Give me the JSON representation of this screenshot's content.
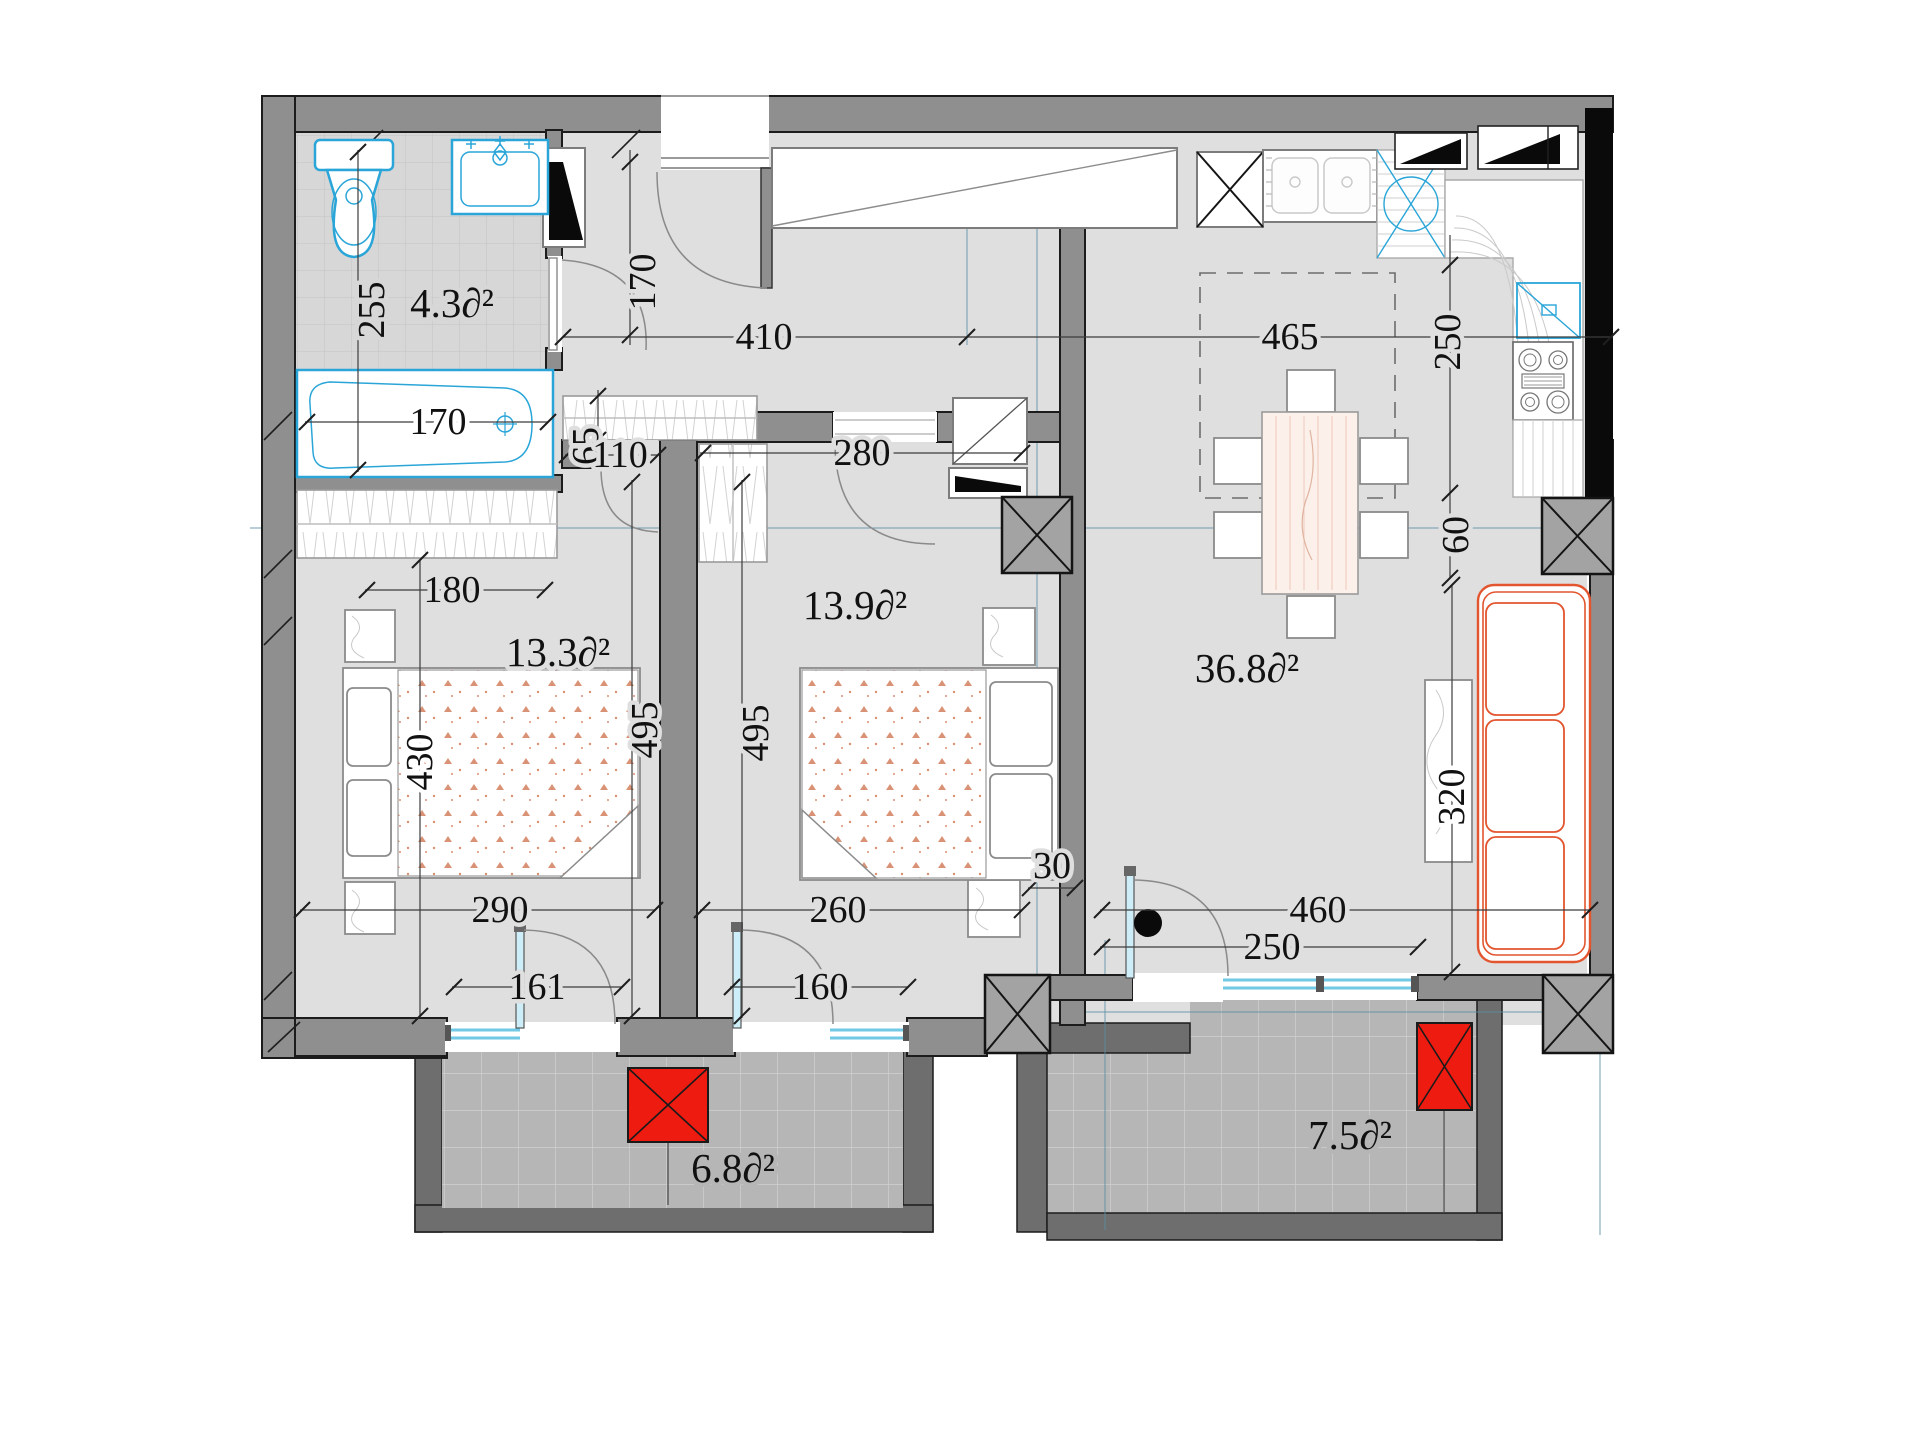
{
  "title": "Apartment floor plan",
  "unit": "∂²",
  "areas": {
    "bathroom": "4.3∂²",
    "bedroom1": "13.3∂²",
    "bedroom2": "13.9∂²",
    "living": "36.8∂²",
    "balcony_left": "6.8∂²",
    "balcony_right": "7.5∂²"
  },
  "dims": {
    "bath_width": "255",
    "bathtub_length": "170",
    "hall_depth": "170",
    "hall_width": "410",
    "kitchen_width": "465",
    "kitchen_depth": "250",
    "closet_depth": "65",
    "closet_width": "110",
    "bedroom2_width": "280",
    "wardrobe_width": "180",
    "bedroom1_length": "495",
    "bedroom2_length": "495",
    "bed_wall": "430",
    "bedroom1_width": "290",
    "balcony_door1": "161",
    "bedroom2_width_b": "260",
    "balcony_door2": "160",
    "wall_thickness": "30",
    "living_width": "460",
    "living_door": "250",
    "sofa_wall": "320",
    "column_gap": "60"
  },
  "colors": {
    "wall": "#8f8f8f",
    "floor": "#dfdfdf",
    "balcony_floor": "#b6b6b6",
    "fixture_blue": "#2aa5d8",
    "sofa_orange": "#e2552f",
    "ac_red": "#ee1b11",
    "axis_teal": "#5b8fa4"
  }
}
